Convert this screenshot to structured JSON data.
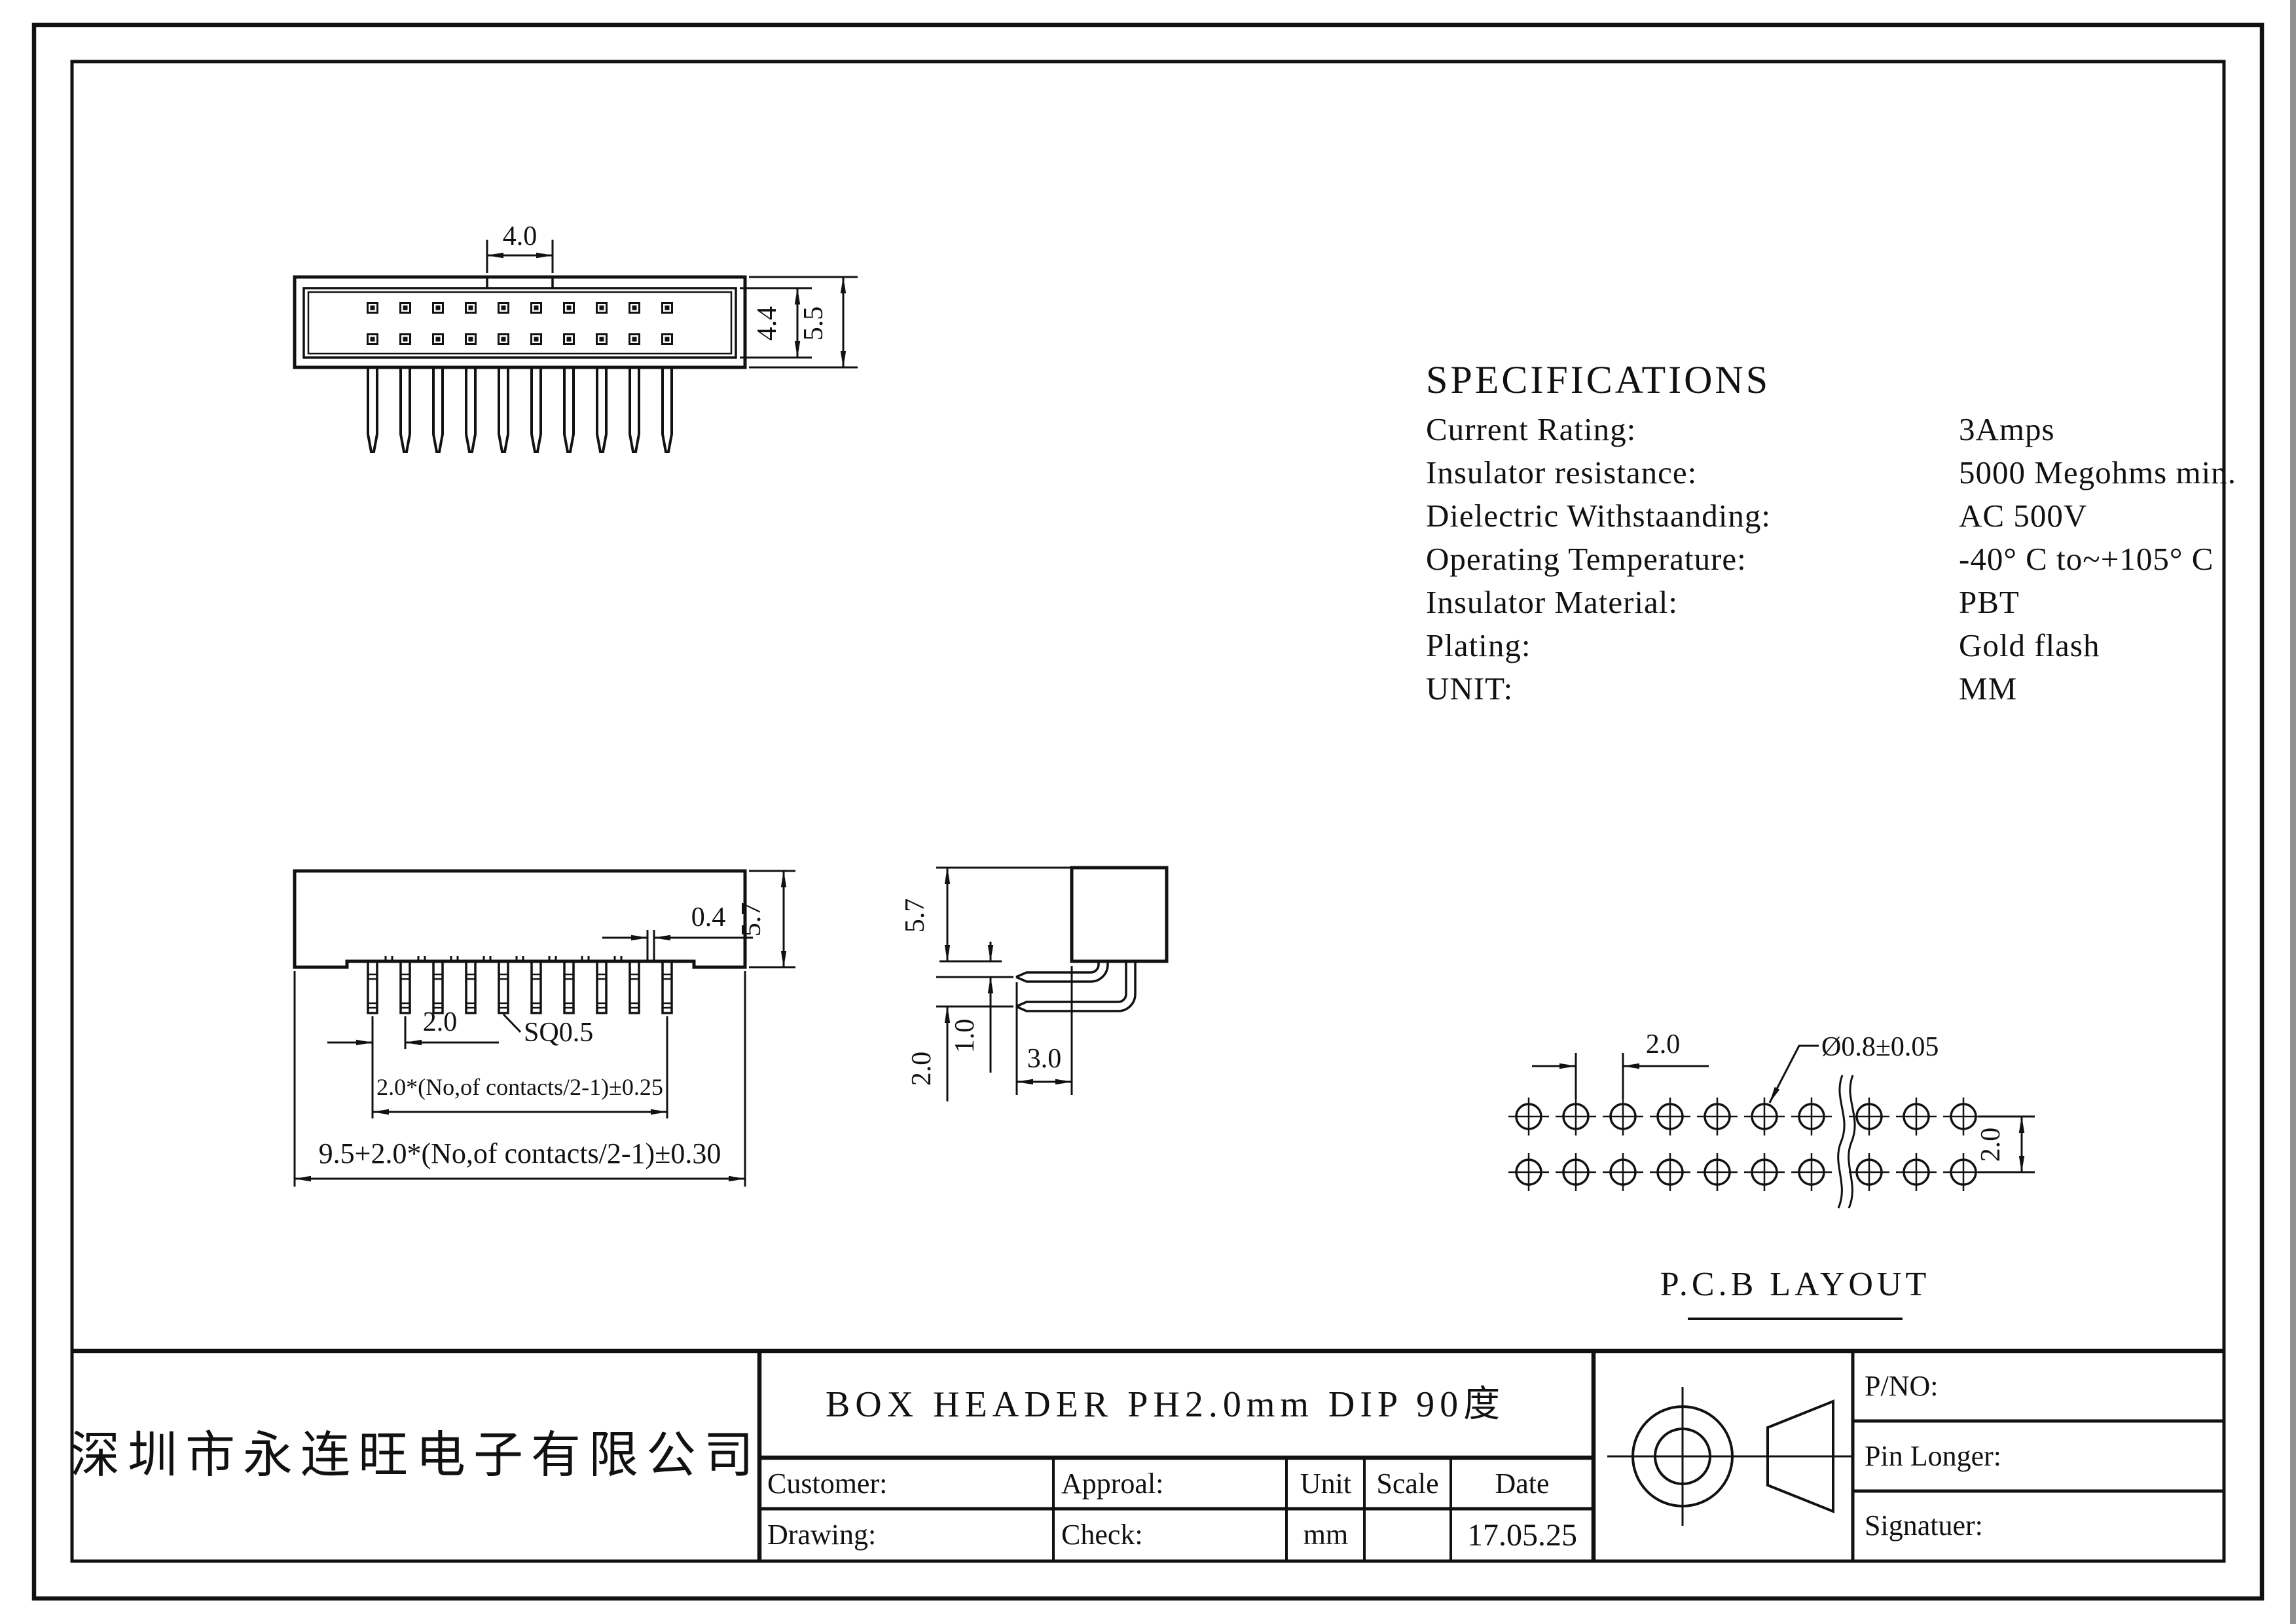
{
  "specifications": {
    "title": "SPECIFICATIONS",
    "rows": [
      {
        "label": "Current Rating:",
        "value": "3Amps"
      },
      {
        "label": "Insulator resistance:",
        "value": "5000 Megohms min."
      },
      {
        "label": "Dielectric Withstaanding:",
        "value": "AC 500V"
      },
      {
        "label": "Operating Temperature:",
        "value": "-40° C to~+105° C"
      },
      {
        "label": "Insulator Material:",
        "value": "PBT"
      },
      {
        "label": "Plating:",
        "value": "Gold flash"
      },
      {
        "label": "UNIT:",
        "value": "MM"
      }
    ]
  },
  "top_view": {
    "dim_tab": "4.0",
    "dim_inner_height": "4.4",
    "dim_outer_height": "5.5"
  },
  "front_view": {
    "dim_height": "5.7",
    "dim_notch": "0.4",
    "dim_pitch": "2.0",
    "dim_pin_square": "SQ0.5",
    "dim_span": "2.0*(No,of contacts/2-1)±0.25",
    "dim_total": "9.5+2.0*(No,of contacts/2-1)±0.30"
  },
  "side_view": {
    "dim_height": "5.7",
    "dim_offset": "1.0",
    "dim_row_pitch": "2.0",
    "dim_tail": "3.0"
  },
  "pcb_layout": {
    "label": "P.C.B LAYOUT",
    "dim_pitch": "2.0",
    "dim_hole_dia": "Ø0.8±0.05",
    "dim_row_pitch": "2.0"
  },
  "title_block": {
    "company": "深圳市永连旺电子有限公司",
    "drawing_title": "BOX HEADER PH2.0mm DIP 90度",
    "labels": {
      "customer": "Customer:",
      "approal": "Approal:",
      "unit": "Unit",
      "scale": "Scale",
      "date": "Date",
      "drawing": "Drawing:",
      "check": "Check:",
      "pno": "P/NO:",
      "pin_longer": "Pin Longer:",
      "signatuer": "Signatuer:"
    },
    "values": {
      "unit_value": "mm",
      "date_value": "17.05.25"
    }
  },
  "geometry": {
    "pins_per_row": 10,
    "rows": 2,
    "holes_per_row": 10
  }
}
